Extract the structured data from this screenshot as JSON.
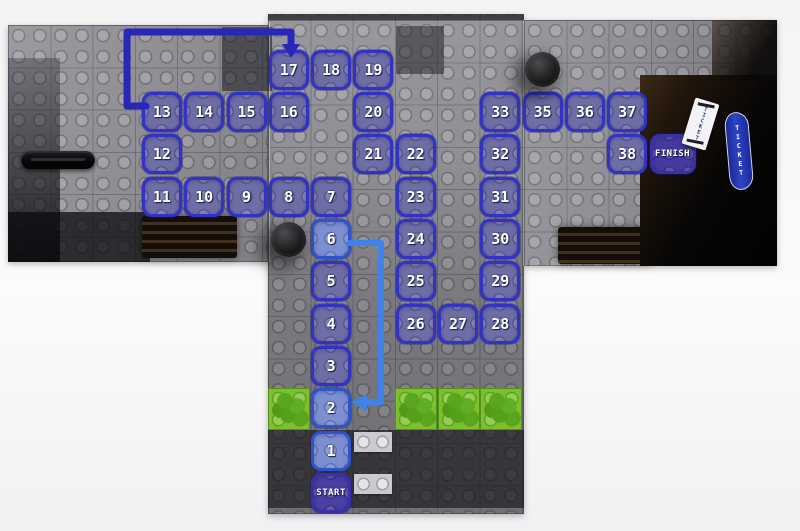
{
  "game": {
    "type": "lego-style race board, T-shaped jigsaw, photographed on white",
    "labels": {
      "start": "START",
      "finish": "FINISH"
    },
    "tickets": {
      "paper_label": "TICKET",
      "banner_label": "TICKET"
    },
    "board": {
      "colors": {
        "base_gray": "#8f8f95",
        "tile_border_blue": "#3232c4",
        "tile_fill_blue": "#6e6ea6",
        "start_finish_indigo": "#4a3fa2",
        "green_cell": "#7cc12d",
        "link_dark_blue": "#2828b8",
        "link_light_blue": "#3f82e8"
      },
      "spaces": [
        {
          "label": "17",
          "col": 6,
          "row": 0
        },
        {
          "label": "18",
          "col": 7,
          "row": 0
        },
        {
          "label": "19",
          "col": 8,
          "row": 0
        },
        {
          "label": "13",
          "col": 3,
          "row": 1
        },
        {
          "label": "14",
          "col": 4,
          "row": 1
        },
        {
          "label": "15",
          "col": 5,
          "row": 1
        },
        {
          "label": "16",
          "col": 6,
          "row": 1
        },
        {
          "label": "20",
          "col": 8,
          "row": 1
        },
        {
          "label": "33",
          "col": 11,
          "row": 1
        },
        {
          "label": "35",
          "col": 12,
          "row": 1
        },
        {
          "label": "36",
          "col": 13,
          "row": 1
        },
        {
          "label": "37",
          "col": 14,
          "row": 1
        },
        {
          "label": "12",
          "col": 3,
          "row": 2
        },
        {
          "label": "21",
          "col": 8,
          "row": 2
        },
        {
          "label": "22",
          "col": 9,
          "row": 2
        },
        {
          "label": "32",
          "col": 11,
          "row": 2
        },
        {
          "label": "38",
          "col": 14,
          "row": 2
        },
        {
          "label": "FINISH",
          "col": 15,
          "row": 2,
          "type": "finish"
        },
        {
          "label": "11",
          "col": 3,
          "row": 3
        },
        {
          "label": "10",
          "col": 4,
          "row": 3
        },
        {
          "label": "9",
          "col": 5,
          "row": 3
        },
        {
          "label": "8",
          "col": 6,
          "row": 3
        },
        {
          "label": "7",
          "col": 7,
          "row": 3
        },
        {
          "label": "23",
          "col": 9,
          "row": 3
        },
        {
          "label": "31",
          "col": 11,
          "row": 3
        },
        {
          "label": "6",
          "col": 7,
          "row": 4,
          "type": "light"
        },
        {
          "label": "24",
          "col": 9,
          "row": 4
        },
        {
          "label": "30",
          "col": 11,
          "row": 4
        },
        {
          "label": "5",
          "col": 7,
          "row": 5
        },
        {
          "label": "25",
          "col": 9,
          "row": 5
        },
        {
          "label": "29",
          "col": 11,
          "row": 5
        },
        {
          "label": "4",
          "col": 7,
          "row": 6
        },
        {
          "label": "26",
          "col": 9,
          "row": 6
        },
        {
          "label": "27",
          "col": 10,
          "row": 6
        },
        {
          "label": "28",
          "col": 11,
          "row": 6
        },
        {
          "label": "3",
          "col": 7,
          "row": 7
        },
        {
          "label": "2",
          "col": 7,
          "row": 8,
          "type": "light"
        },
        {
          "label": "1",
          "col": 7,
          "row": 9,
          "type": "light"
        },
        {
          "label": "START",
          "col": 7,
          "row": 10,
          "type": "start"
        }
      ],
      "green_cells": [
        {
          "col": 6,
          "row": 8
        },
        {
          "col": 9,
          "row": 8
        },
        {
          "col": 10,
          "row": 8
        },
        {
          "col": 11,
          "row": 8
        }
      ],
      "light_cells": [
        {
          "col": 8,
          "row": 9
        },
        {
          "col": 8,
          "row": 10
        }
      ],
      "pieces": [
        {
          "name": "black-round-piece",
          "col": 6,
          "row": 4
        },
        {
          "name": "black-round-piece",
          "col": 12,
          "row": 0
        }
      ],
      "path_links": [
        {
          "from": "13",
          "to": "17",
          "style": "dark-blue-arrow"
        },
        {
          "from": "6",
          "to": "2",
          "style": "light-blue-arrow"
        }
      ]
    }
  }
}
